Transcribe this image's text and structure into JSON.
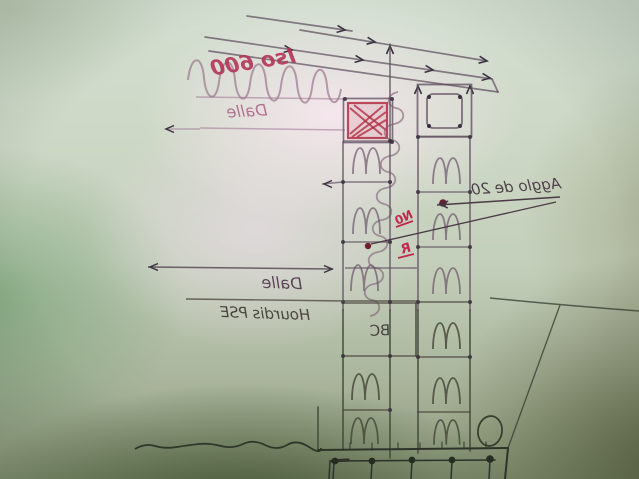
{
  "photo": {
    "kind": "hand-drawn construction detail sketch, photographed mirrored",
    "text_mirrored": true,
    "annotations": {
      "insulation_label": "Iso 600",
      "top_slab_label": "Dalle",
      "block_wall_label": "Agglo de 20",
      "floor_slab_label": "Dalle",
      "floor_system_label": "Hourdis PSE",
      "column_label": "BC",
      "point_mark_upper": "N0",
      "point_mark_lower": "R"
    },
    "colors": {
      "paper_green_edge": "#8e9a7b",
      "paper_pink_center": "#f2e4ec",
      "pencil_upper": "#5d4a5c",
      "pencil_lower": "#30372a",
      "red_ink": "#b33050",
      "dark_red_dot": "#6d1f2a"
    }
  }
}
